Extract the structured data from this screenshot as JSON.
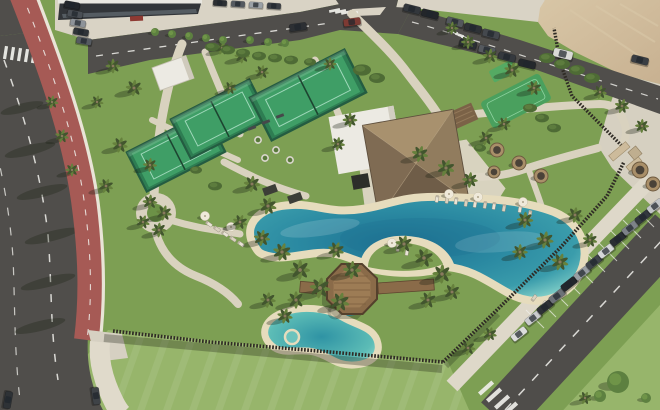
{
  "scene": {
    "kind": "aerial-drone-photo-resort",
    "palette": {
      "grass_base": "#7d9f53",
      "grass_dark": "#6c9147",
      "lawn_bright": "#97b56b",
      "asphalt": "#504e4b",
      "asphalt_dark": "#454341",
      "road_line": "#f1f1ec",
      "bike_lane": "#a65a55",
      "sidewalk": "#e0dacb",
      "curb": "#e9e4d7",
      "path": "#d9d2bf",
      "forecourt": "#d9d3c5",
      "sand_lot": "#c8b191",
      "sand_light": "#d8c6a6",
      "pool_edge": "#e6dcbd",
      "pool_shallow": "#8fd9cd",
      "pool_mid": "#3a9cab",
      "pool_deep": "#1d7091",
      "thatch_n": "#a8916e",
      "thatch_e": "#917c5e",
      "thatch_s": "#6f5d48",
      "thatch_w": "#7f6b53",
      "white_roof": "#eceae3",
      "court_green": "#3f9e66",
      "court_line": "#9fd8ba",
      "court_fence": "#245c41",
      "timber_fence": "#2f2b25",
      "deck_wood": "#8a6b49",
      "deck_light": "#9d7c55",
      "palm_dark": "#42552e",
      "palm_light": "#66813d",
      "trunk": "#8d7d64",
      "shadow": "rgba(25,32,18,0.32)",
      "car_glass": "#20262c",
      "building_facade": "#323539",
      "sign_red": "#8e3a33",
      "gate_wall": "#cdbb9b"
    },
    "palms": [
      [
        113,
        66,
        0.85
      ],
      [
        134,
        88,
        0.95
      ],
      [
        120,
        145,
        0.9
      ],
      [
        106,
        186,
        0.85
      ],
      [
        150,
        165,
        0.8
      ],
      [
        97,
        102,
        0.75
      ],
      [
        222,
        48,
        0.8
      ],
      [
        242,
        56,
        0.85
      ],
      [
        262,
        72,
        0.8
      ],
      [
        230,
        88,
        0.75
      ],
      [
        330,
        64,
        0.75
      ],
      [
        252,
        184,
        0.95
      ],
      [
        268,
        206,
        1.0
      ],
      [
        240,
        222,
        0.85
      ],
      [
        150,
        202,
        0.85
      ],
      [
        164,
        213,
        0.9
      ],
      [
        143,
        222,
        0.8
      ],
      [
        159,
        230,
        0.85
      ],
      [
        262,
        238,
        0.95
      ],
      [
        282,
        252,
        1.05
      ],
      [
        300,
        270,
        1.15
      ],
      [
        320,
        288,
        1.2
      ],
      [
        340,
        302,
        1.1
      ],
      [
        296,
        300,
        1.0
      ],
      [
        268,
        300,
        0.9
      ],
      [
        285,
        316,
        0.9
      ],
      [
        336,
        250,
        0.95
      ],
      [
        352,
        270,
        1.05
      ],
      [
        404,
        244,
        1.0
      ],
      [
        424,
        258,
        1.1
      ],
      [
        442,
        274,
        1.1
      ],
      [
        452,
        292,
        0.95
      ],
      [
        428,
        300,
        0.95
      ],
      [
        350,
        120,
        0.85
      ],
      [
        338,
        144,
        0.8
      ],
      [
        420,
        154,
        0.95
      ],
      [
        446,
        168,
        1.0
      ],
      [
        470,
        180,
        0.9
      ],
      [
        486,
        138,
        0.85
      ],
      [
        504,
        124,
        0.8
      ],
      [
        525,
        220,
        0.95
      ],
      [
        545,
        240,
        1.0
      ],
      [
        560,
        262,
        1.0
      ],
      [
        520,
        252,
        0.9
      ],
      [
        575,
        215,
        0.9
      ],
      [
        590,
        240,
        0.85
      ],
      [
        468,
        42,
        0.8
      ],
      [
        490,
        56,
        0.85
      ],
      [
        512,
        70,
        0.9
      ],
      [
        534,
        88,
        0.85
      ],
      [
        452,
        28,
        0.75
      ],
      [
        600,
        92,
        0.8
      ],
      [
        622,
        106,
        0.85
      ],
      [
        642,
        126,
        0.8
      ],
      [
        52,
        102,
        0.75
      ],
      [
        62,
        136,
        0.8
      ],
      [
        72,
        170,
        0.75
      ],
      [
        468,
        348,
        0.85
      ],
      [
        490,
        334,
        0.8
      ],
      [
        585,
        398,
        0.75
      ]
    ],
    "street_trees": [
      [
        155,
        32,
        4
      ],
      [
        172,
        34,
        4
      ],
      [
        189,
        36,
        4
      ],
      [
        206,
        38,
        4
      ],
      [
        223,
        40,
        4
      ],
      [
        250,
        40,
        4
      ],
      [
        268,
        42,
        4
      ],
      [
        285,
        43,
        4
      ],
      [
        618,
        382,
        11
      ],
      [
        600,
        396,
        6
      ],
      [
        646,
        398,
        5
      ]
    ],
    "bushes": [
      [
        212,
        47,
        7
      ],
      [
        228,
        50,
        7
      ],
      [
        243,
        53,
        7
      ],
      [
        259,
        56,
        7
      ],
      [
        275,
        58,
        7
      ],
      [
        291,
        60,
        7
      ],
      [
        310,
        62,
        6
      ],
      [
        362,
        70,
        9
      ],
      [
        377,
        78,
        8
      ],
      [
        547,
        58,
        8
      ],
      [
        562,
        64,
        8
      ],
      [
        577,
        70,
        8
      ],
      [
        592,
        78,
        8
      ],
      [
        530,
        108,
        7
      ],
      [
        542,
        118,
        7
      ],
      [
        554,
        128,
        7
      ],
      [
        215,
        186,
        7
      ],
      [
        196,
        170,
        6
      ],
      [
        480,
        148,
        6
      ]
    ],
    "loungers": [
      [
        437,
        199,
        100
      ],
      [
        447,
        200,
        100
      ],
      [
        456,
        201,
        100
      ],
      [
        466,
        203,
        100
      ],
      [
        475,
        204,
        100
      ],
      [
        485,
        205,
        100
      ],
      [
        494,
        206,
        100
      ],
      [
        504,
        208,
        100
      ],
      [
        520,
        209,
        100
      ],
      [
        530,
        214,
        100
      ],
      [
        209,
        224,
        35
      ],
      [
        217,
        229,
        35
      ],
      [
        225,
        234,
        35
      ],
      [
        233,
        239,
        35
      ],
      [
        241,
        244,
        35
      ],
      [
        534,
        298,
        -55
      ],
      [
        544,
        304,
        -55
      ],
      [
        398,
        248,
        100
      ],
      [
        407,
        252,
        100
      ]
    ],
    "parasols": [
      [
        205,
        216
      ],
      [
        231,
        227
      ],
      [
        449,
        194
      ],
      [
        478,
        197
      ],
      [
        392,
        243
      ],
      [
        523,
        202
      ]
    ],
    "daybed_pods": [
      [
        497,
        150,
        7
      ],
      [
        519,
        163,
        7
      ],
      [
        541,
        176,
        7
      ],
      [
        494,
        172,
        6
      ],
      [
        640,
        170,
        8
      ],
      [
        653,
        184,
        7
      ]
    ],
    "planters": [
      [
        258,
        140
      ],
      [
        276,
        150
      ],
      [
        290,
        160
      ],
      [
        265,
        158
      ]
    ],
    "gym_mats": [
      [
        270,
        190
      ],
      [
        295,
        198
      ]
    ],
    "benches": [
      [
        252,
        128
      ],
      [
        266,
        122
      ],
      [
        280,
        116
      ]
    ],
    "cars": [
      [
        533,
        318,
        -38,
        "#caccce"
      ],
      [
        545,
        307,
        -38,
        "#2e3236"
      ],
      [
        557,
        296,
        -38,
        "#6d7278"
      ],
      [
        569,
        284,
        -38,
        "#23272c"
      ],
      [
        582,
        273,
        -38,
        "#989da2"
      ],
      [
        594,
        262,
        -38,
        "#3f444a"
      ],
      [
        606,
        251,
        -38,
        "#d5d7d8"
      ],
      [
        618,
        239,
        -38,
        "#2a2e33"
      ],
      [
        630,
        228,
        -38,
        "#7d8288"
      ],
      [
        643,
        217,
        -38,
        "#33383e"
      ],
      [
        655,
        206,
        -38,
        "#c2c5c7"
      ],
      [
        519,
        334,
        -38,
        "#dcdddc"
      ],
      [
        412,
        9,
        14,
        "#33373c"
      ],
      [
        430,
        14,
        14,
        "#23262a"
      ],
      [
        455,
        22,
        14,
        "#53575c"
      ],
      [
        473,
        28,
        14,
        "#2e3236"
      ],
      [
        491,
        34,
        14,
        "#44484d"
      ],
      [
        468,
        44,
        14,
        "#2b2f34"
      ],
      [
        487,
        50,
        14,
        "#55595e"
      ],
      [
        507,
        57,
        14,
        "#35393e"
      ],
      [
        527,
        64,
        14,
        "#24282c"
      ],
      [
        640,
        60,
        14,
        "#3a3e43"
      ],
      [
        563,
        54,
        14,
        "#d9d9d5",
        1.15
      ],
      [
        352,
        22,
        -8,
        "#7d3a33"
      ],
      [
        298,
        27,
        -8,
        "#2c2f33"
      ],
      [
        72,
        5,
        10,
        "#23262b",
        0.9
      ],
      [
        75,
        14,
        10,
        "#4a4f55",
        0.9
      ],
      [
        78,
        23,
        10,
        "#8e9399",
        0.9
      ],
      [
        81,
        32,
        10,
        "#2f3338",
        0.9
      ],
      [
        84,
        41,
        10,
        "#565b61",
        0.9
      ],
      [
        220,
        3,
        4,
        "#2c2f33",
        0.8
      ],
      [
        238,
        4,
        4,
        "#555a60",
        0.8
      ],
      [
        256,
        5,
        4,
        "#9aa0a6",
        0.8
      ],
      [
        274,
        6,
        4,
        "#3a3e44",
        0.8
      ],
      [
        96,
        396,
        82,
        "#3f4347"
      ],
      [
        8,
        400,
        100,
        "#2e3236"
      ]
    ]
  }
}
